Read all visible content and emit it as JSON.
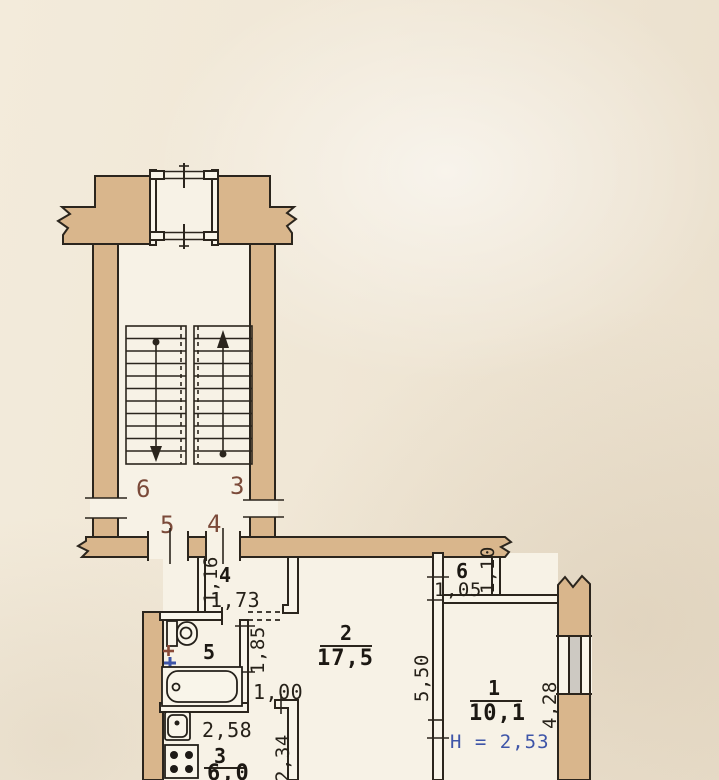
{
  "plan": {
    "landing": {
      "apt_top_left": "6",
      "apt_top_right": "3",
      "apt_bottom_left": "5",
      "apt_bottom_right": "4"
    },
    "rooms": {
      "hall": {
        "number": "4",
        "width": "1,16",
        "length": "1,73"
      },
      "bathroom": {
        "number": "5",
        "wall_length": "1,85",
        "opening": "1,00"
      },
      "living": {
        "number": "2",
        "area": "17,5",
        "length": "5,50"
      },
      "closet": {
        "number": "6",
        "width": "1,05",
        "depth": "1,10"
      },
      "room1": {
        "number": "1",
        "area": "10,1",
        "ceiling_height": "H = 2,53",
        "wall_length": "4,28"
      },
      "kitchen": {
        "number": "3",
        "area": "6,0",
        "width": "2,58",
        "depth": "2,34"
      }
    },
    "colors": {
      "paper": "#efe6d5",
      "room_fill": "#f7f2e6",
      "wall_fill": "#d9b68c",
      "ink": "#2b251d",
      "apartment_number_brown": "#7b4a39",
      "height_note_blue": "#3e55a8",
      "window_glass": "#cdc9c2"
    }
  }
}
